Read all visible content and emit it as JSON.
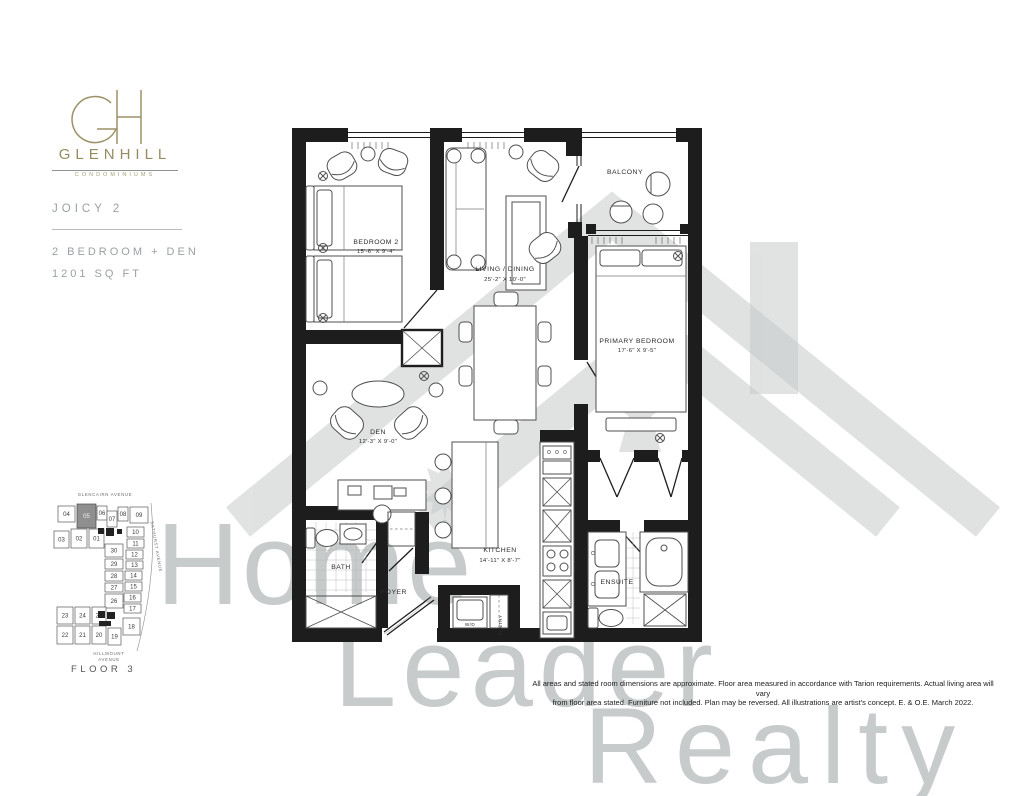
{
  "brand": {
    "monogram": "GH",
    "name": "GLENHILL",
    "subtitle": "CONDOMINIUMS"
  },
  "plan": {
    "name": "JOICY 2",
    "type": "2 BEDROOM + DEN",
    "area": "1201 SQ FT"
  },
  "floorplan": {
    "rooms": {
      "bedroom2": {
        "label": "BEDROOM 2",
        "dims": "15'-6\" X 9'-4\""
      },
      "living": {
        "label": "LIVING / DINING",
        "dims": "25'-2\" X 10'-0\""
      },
      "balcony": {
        "label": "BALCONY"
      },
      "primary": {
        "label": "PRIMARY BEDROOM",
        "dims": "17'-6\" X 9'-5\""
      },
      "den": {
        "label": "DEN",
        "dims": "12'-3\" X 9'-0\""
      },
      "kitchen": {
        "label": "KITCHEN",
        "dims": "14'-11\" X 8'-7\""
      },
      "bath": {
        "label": "BATH"
      },
      "foyer": {
        "label": "FOYER"
      },
      "ensuite": {
        "label": "ENSUITE"
      },
      "pantry": {
        "label": "PANTRY"
      },
      "wd": {
        "label": "W/D"
      }
    }
  },
  "keyplan": {
    "streets": {
      "top": "GLENCAIRN AVENUE",
      "right": "BATHURST AVENUE",
      "bottom_line1": "HILLMOUNT",
      "bottom_line2": "AVENUE"
    },
    "floor_label": "FLOOR 3",
    "highlighted_unit": "05",
    "cells": [
      {
        "label": "04",
        "x": 13,
        "y": 19,
        "w": 17,
        "h": 16
      },
      {
        "label": "05",
        "x": 32,
        "y": 17,
        "w": 19,
        "h": 24,
        "dark": true
      },
      {
        "label": "06",
        "x": 52,
        "y": 19,
        "w": 10,
        "h": 14
      },
      {
        "label": "07",
        "x": 62,
        "y": 24,
        "w": 10,
        "h": 16
      },
      {
        "label": "08",
        "x": 73,
        "y": 20,
        "w": 10,
        "h": 14
      },
      {
        "label": "09",
        "x": 85,
        "y": 20,
        "w": 18,
        "h": 16
      },
      {
        "label": "03",
        "x": 9,
        "y": 44,
        "w": 15,
        "h": 17
      },
      {
        "label": "02",
        "x": 26,
        "y": 42,
        "w": 16,
        "h": 19
      },
      {
        "label": "01",
        "x": 44,
        "y": 42,
        "w": 15,
        "h": 19
      },
      {
        "label": "30",
        "x": 60,
        "y": 57,
        "w": 18,
        "h": 13
      },
      {
        "label": "29",
        "x": 60,
        "y": 72,
        "w": 18,
        "h": 10
      },
      {
        "label": "28",
        "x": 60,
        "y": 84,
        "w": 18,
        "h": 10
      },
      {
        "label": "27",
        "x": 60,
        "y": 96,
        "w": 18,
        "h": 9
      },
      {
        "label": "26",
        "x": 60,
        "y": 107,
        "w": 18,
        "h": 14
      },
      {
        "label": "10",
        "x": 82,
        "y": 40,
        "w": 17,
        "h": 10
      },
      {
        "label": "11",
        "x": 82,
        "y": 52,
        "w": 17,
        "h": 9
      },
      {
        "label": "12",
        "x": 81,
        "y": 63,
        "w": 17,
        "h": 9
      },
      {
        "label": "13",
        "x": 81,
        "y": 74,
        "w": 17,
        "h": 8
      },
      {
        "label": "14",
        "x": 80,
        "y": 84,
        "w": 17,
        "h": 9
      },
      {
        "label": "15",
        "x": 80,
        "y": 95,
        "w": 17,
        "h": 9
      },
      {
        "label": "16",
        "x": 79,
        "y": 106,
        "w": 17,
        "h": 9
      },
      {
        "label": "17",
        "x": 79,
        "y": 117,
        "w": 17,
        "h": 9
      },
      {
        "label": "23",
        "x": 12,
        "y": 120,
        "w": 16,
        "h": 17
      },
      {
        "label": "24",
        "x": 30,
        "y": 120,
        "w": 15,
        "h": 17
      },
      {
        "label": "25",
        "x": 47,
        "y": 120,
        "w": 14,
        "h": 17
      },
      {
        "label": "22",
        "x": 12,
        "y": 139,
        "w": 16,
        "h": 18
      },
      {
        "label": "21",
        "x": 30,
        "y": 139,
        "w": 15,
        "h": 18
      },
      {
        "label": "20",
        "x": 47,
        "y": 139,
        "w": 14,
        "h": 18
      },
      {
        "label": "19",
        "x": 63,
        "y": 141,
        "w": 13,
        "h": 17
      },
      {
        "label": "18",
        "x": 78,
        "y": 131,
        "w": 17,
        "h": 17
      }
    ]
  },
  "watermark": {
    "word1": "Home",
    "word2": "Leader",
    "word3": "Realty"
  },
  "disclaimer": {
    "line1": "All areas and stated room dimensions are approximate. Floor area measured in accordance with Tarion requirements. Actual living area will vary",
    "line2": "from floor area stated. Furniture not included. Plan may be reversed. All illustrations are artist's concept. E. & O.E. March 2022."
  },
  "colors": {
    "gold": "#968c60",
    "text_gray": "#9aa0a2",
    "wall": "#1d1d1d",
    "watermark": "#c7cbcb",
    "highlight_unit": "#8f8f8f"
  }
}
